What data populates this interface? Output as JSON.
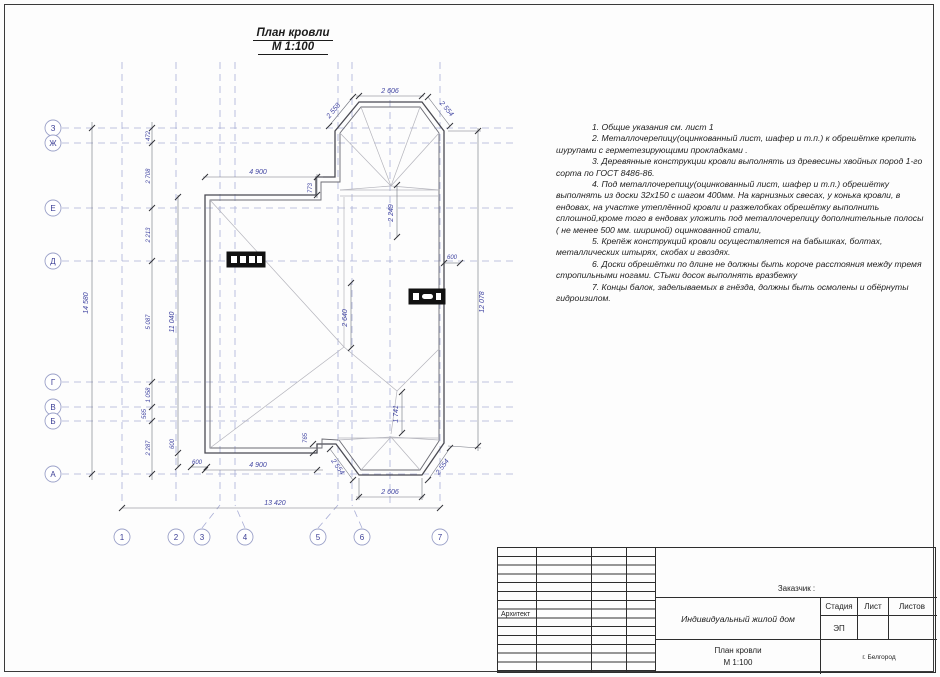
{
  "sheet": {
    "title": "План кровли",
    "scale": "М 1:100"
  },
  "notes": [
    "1.   Общие указания см. лист 1",
    "2.   Металлочерепицу(оцинкованный лист, шафер и т.п.) к обрешётке крепить шурупами с герметезирующими прокладками .",
    "3.   Деревянные конструкции кровли выполнять из древесины хвойных пород 1-го сорта по ГОСТ 8486-86.",
    "4.   Под  металлочерепицу(оцинкованный лист, шафер и т.п.) обрешётку выполнять из доски 32х150 с шагом 400мм. На карнизных свесах, у конька кровли, в ендовах, на участке утеплённой кровли и разжелобках обрешётку выполнить сплошной,кроме того в ендовах уложить под металлочерепицу дополнительные полосы ( не менее 500 мм. шириной) оцинкованной стали,",
    "5.   Крепёж конструкций кровли осуществляется на бабышках, болтах, металлических штырях, скобах и гвоздях.",
    "6.   Доски обрешётки по длине не должны быть короче расстояния между тремя стропильными ногами. СТыки досок выполнять вразбежку",
    "7.   Концы балок, заделываемых в гнёзда, должны быть осмолены и обёрнуты гидроизилом."
  ],
  "axes": {
    "h": [
      "1",
      "2",
      "3",
      "4",
      "5",
      "6",
      "7"
    ],
    "v": [
      "З",
      "Ж",
      "Е",
      "Д",
      "Г",
      "В",
      "Б",
      "А"
    ]
  },
  "dims": {
    "overall_h": "14 580",
    "overall_w": "13 420",
    "chain": [
      "472",
      "2 708",
      "2 213",
      "5 087",
      "1 058",
      "565",
      "2 287"
    ],
    "inner_h": "11 040",
    "right_h": "12 078",
    "top_w": "4 900",
    "bottom_w": "4 900",
    "bay_top_top": "2 606",
    "bay_top_left": "2 558",
    "bay_top_right": "2 554",
    "bay_bot_bottom": "2 606",
    "bay_bot_left": "2 554",
    "bay_bot_right": "2 554",
    "notch_top": "773",
    "notch_bot": "765",
    "bay_top_depth": "2 249",
    "ridge_len": "2 640",
    "valley_len": "1 741",
    "eave_right": "600",
    "eave_left_v": "600",
    "eave_left_h": "600"
  },
  "titleblock": {
    "customer_label": "Заказчик :",
    "architect_label": "Архитект",
    "project": "Индивидуальный жилой дом",
    "stage_label": "Стадия",
    "sheet_label": "Лист",
    "sheets_label": "Листов",
    "stage_value": "ЭП",
    "doc_title": "План кровли",
    "doc_scale": "М 1:100",
    "city": "г. Белгород"
  }
}
